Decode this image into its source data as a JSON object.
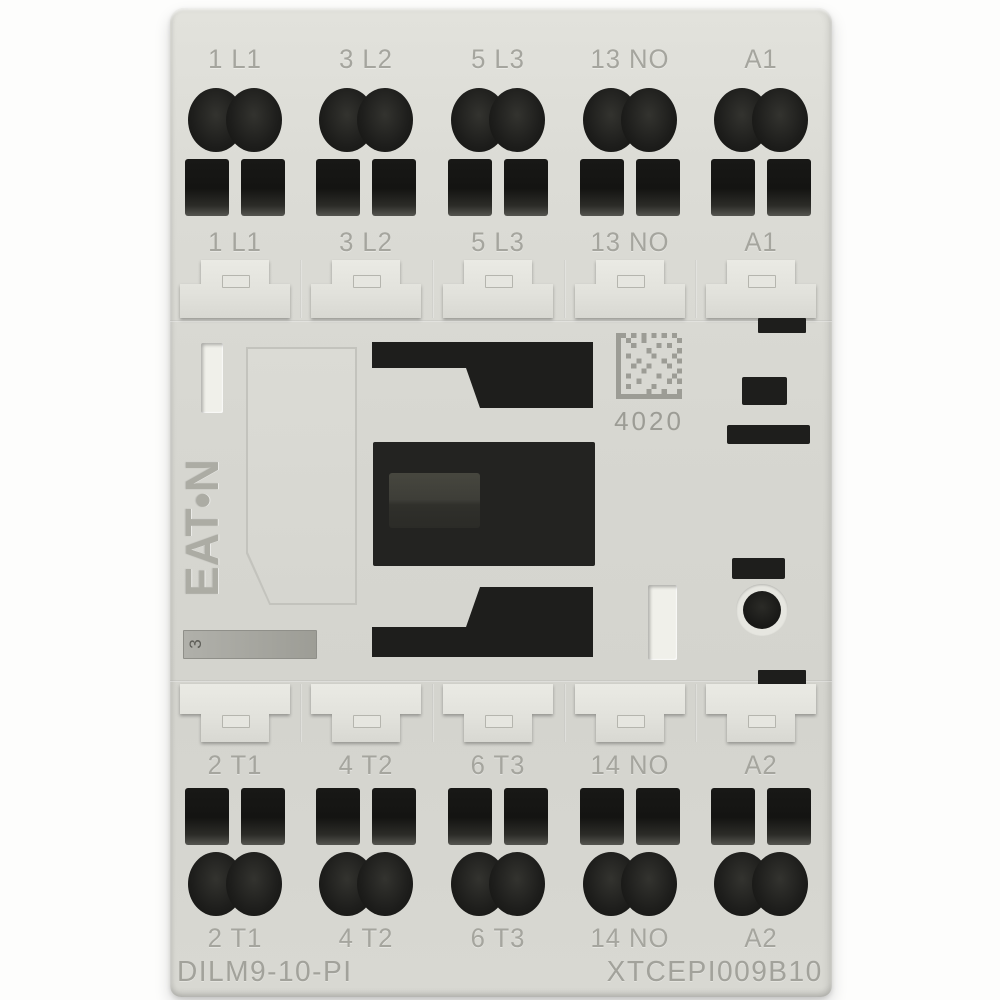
{
  "product": {
    "brand_logo": "EAT•N",
    "slot_marking": "3",
    "datamatrix_label": "4020",
    "model_number": "DILM9-10-PI",
    "catalog_number": "XTCEPI009B10",
    "top_labels": [
      "1 L1",
      "3 L2",
      "5 L3",
      "13 NO",
      "A1"
    ],
    "bottom_labels": [
      "2 T1",
      "4 T2",
      "6 T3",
      "14 NO",
      "A2"
    ]
  },
  "colors": {
    "background": "#fdfdfc",
    "body_gray": "#d8d8d2",
    "hole_black": "#1e1e1c",
    "engraved_text_gray": "#a5a59e",
    "marking_strip_gray": "#a6a69f"
  }
}
